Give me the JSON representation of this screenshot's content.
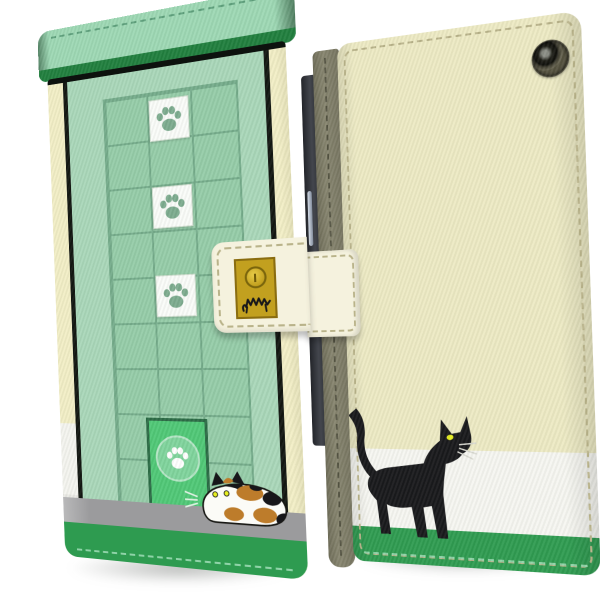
{
  "image": {
    "alt": "Product photo of a flip wallet smartphone case with cat artwork, shown closed from the front and from the back"
  },
  "labels": {
    "stage": "cat wallet phone case product photo",
    "front_view": "front cover view of closed case",
    "back_view": "back cover view of case",
    "flap": "green top flap",
    "grid": "screen-door grid with paw tiles",
    "door": "pet door with paw emblem",
    "calico_cat": "calico cat crouching by the door",
    "black_cat": "black cat walking on the back cover",
    "strap": "clasp strap with snap button",
    "camera": "camera opening",
    "phone_edge": "phone side edge with buttons",
    "spine": "case spine edge"
  },
  "front_view": {
    "grid_columns": 3,
    "grid_rows": 9,
    "paw_tiles": 3,
    "cats": [
      "calico"
    ],
    "bands": [
      "gray-ledge",
      "green-hem"
    ]
  },
  "back_view": {
    "cats": [
      "black"
    ],
    "camera_holes": 1,
    "bands": [
      "cream",
      "white",
      "green-hem"
    ]
  },
  "strap": {
    "snap_buttons": 1,
    "emblem": "scribbled cat"
  },
  "colors": {
    "cream_edge": "#f2eec6",
    "cream_back": "#edeac4",
    "cream_strap": "#f5f2de",
    "green_field": "#a9d7b9",
    "green_panel": "#95cca8",
    "green_line": "#74ab8a",
    "green_flap": "#9dd8b4",
    "green_flap_edge": "#1f7e3d",
    "green_door": "#4fc876",
    "green_door_edge": "#2a6a44",
    "green_door_circle": "#7fd49c",
    "green_band": "#2e9b50",
    "gray_band": "#9b9b9d",
    "paw_green": "#7cab8e",
    "gold": "#c2a01f",
    "gold_edge": "#8a6d10",
    "ink": "#17171a",
    "eye_yellow": "#e6ee21",
    "calico_orange": "#bd7c2b",
    "white_band": "#f6f6f1",
    "spine": "#87856f",
    "stitch_cream": "#b9b38a",
    "stitch_green": "#8fd3a8",
    "stitch_flap": "#5ea07c",
    "shadow": "rgba(70,75,70,0.38)"
  }
}
